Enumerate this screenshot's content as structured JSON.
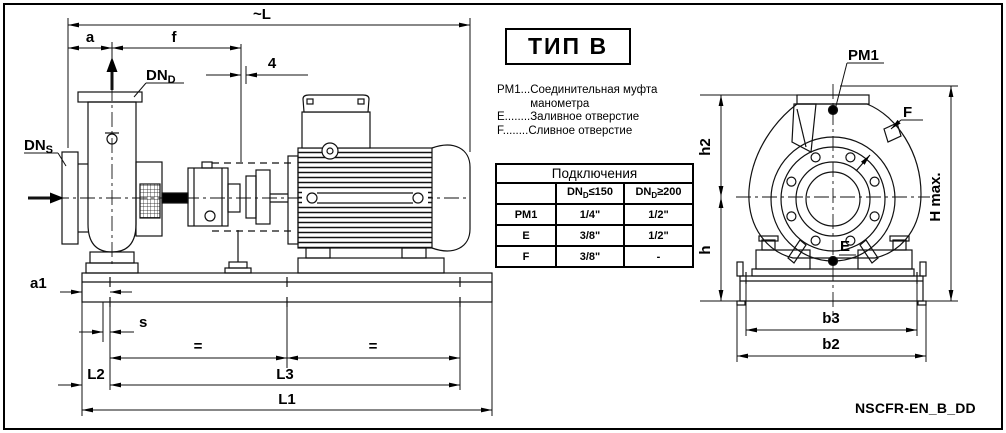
{
  "frame": {
    "code": "NSCFR-EN_B_DD"
  },
  "type_box": {
    "label": "ТИП В"
  },
  "legend": {
    "items": [
      {
        "label": "PM1...",
        "text": "Соединительная муфта манометра"
      },
      {
        "label": "E........",
        "text": "Заливное отверстие"
      },
      {
        "label": "F........",
        "text": "Сливное отверстие"
      }
    ]
  },
  "table": {
    "title": "Подключения",
    "col1": {
      "base": "DN",
      "sub": "D",
      "cond": "≤150"
    },
    "col2": {
      "base": "DN",
      "sub": "D",
      "cond": "≥200"
    },
    "rows": [
      {
        "name": "PM1",
        "v1": "1/4\"",
        "v2": "1/2\""
      },
      {
        "name": "E",
        "v1": "3/8\"",
        "v2": "1/2\""
      },
      {
        "name": "F",
        "v1": "3/8\"",
        "v2": "-"
      }
    ]
  },
  "side_view": {
    "dims": {
      "L": "~L",
      "a": "a",
      "f": "f",
      "gap": "4",
      "a1": "a1",
      "s": "s",
      "eq1": "=",
      "eq2": "=",
      "L2": "L2",
      "L3": "L3",
      "L1": "L1"
    },
    "labels": {
      "dnd_base": "DN",
      "dnd_sub": "D",
      "dns_base": "DN",
      "dns_sub": "S"
    }
  },
  "front_view": {
    "dims": {
      "h2": "h2",
      "h": "h",
      "hmax": "H max.",
      "b3": "b3",
      "b2": "b2"
    },
    "labels": {
      "pm1": "PM1",
      "f": "F",
      "e": "E"
    }
  }
}
